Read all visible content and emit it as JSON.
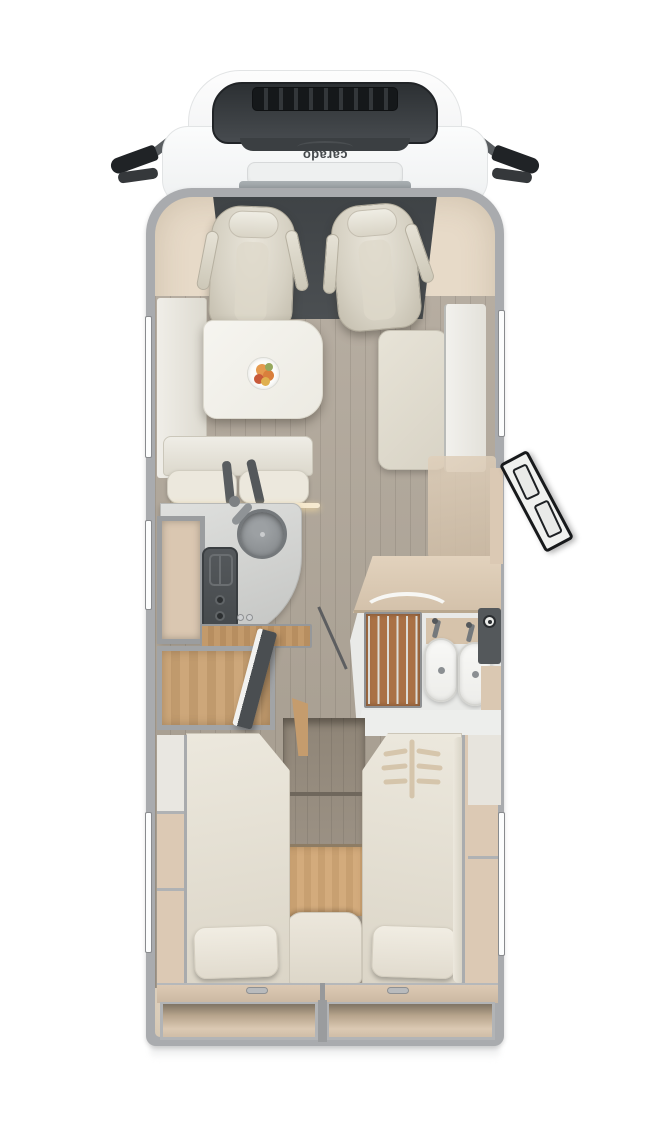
{
  "brand": {
    "logo_text": "carado"
  },
  "palette": {
    "wall-gray": "#a9abae",
    "interior-beige": "#e7dac8",
    "floor-wood": "#b6ada1",
    "warm-wood": "#cda77a",
    "teak-wood": "#aa7145",
    "cushion-cream": "#e7e3d7",
    "counter-gray": "#d4d5d3",
    "cab-dark": "#4b4f52",
    "fixture-white": "#f2f3f1"
  },
  "components": {
    "front": [
      "driver-cab",
      "windshield",
      "roof-vent-grid",
      "side-mirror-left",
      "side-mirror-right",
      "brand-logo",
      "hood-vent"
    ],
    "living": [
      "driver-seat",
      "passenger-seat",
      "dinette-table",
      "fruit-plate",
      "side-bench-left",
      "travel-bench",
      "seat-belts",
      "bench-right",
      "ambient-light-strip"
    ],
    "kitchen": [
      "kitchen-counter",
      "round-sink",
      "faucet",
      "stove",
      "tall-cabinet",
      "wood-sideboard",
      "wardrobe",
      "partition-door"
    ],
    "bathroom": [
      "shower-teak-grate",
      "shower-curtain-arc",
      "toilet",
      "washbasin",
      "bath-faucets",
      "bathroom-cabinet",
      "shower-door"
    ],
    "entry": [
      "entry-door-open",
      "doorway-gap"
    ],
    "bedroom": [
      "single-bed-left",
      "single-bed-right",
      "pillow-left",
      "pillow-right",
      "quilt-pattern",
      "center-steps",
      "step-cushion",
      "storage-shelves-left",
      "storage-shelves-right",
      "bed-deck",
      "rear-storage-left",
      "rear-storage-right"
    ],
    "windows": [
      "window-left-front",
      "window-left-mid",
      "window-left-rear",
      "window-right-front",
      "window-right-rear"
    ]
  }
}
